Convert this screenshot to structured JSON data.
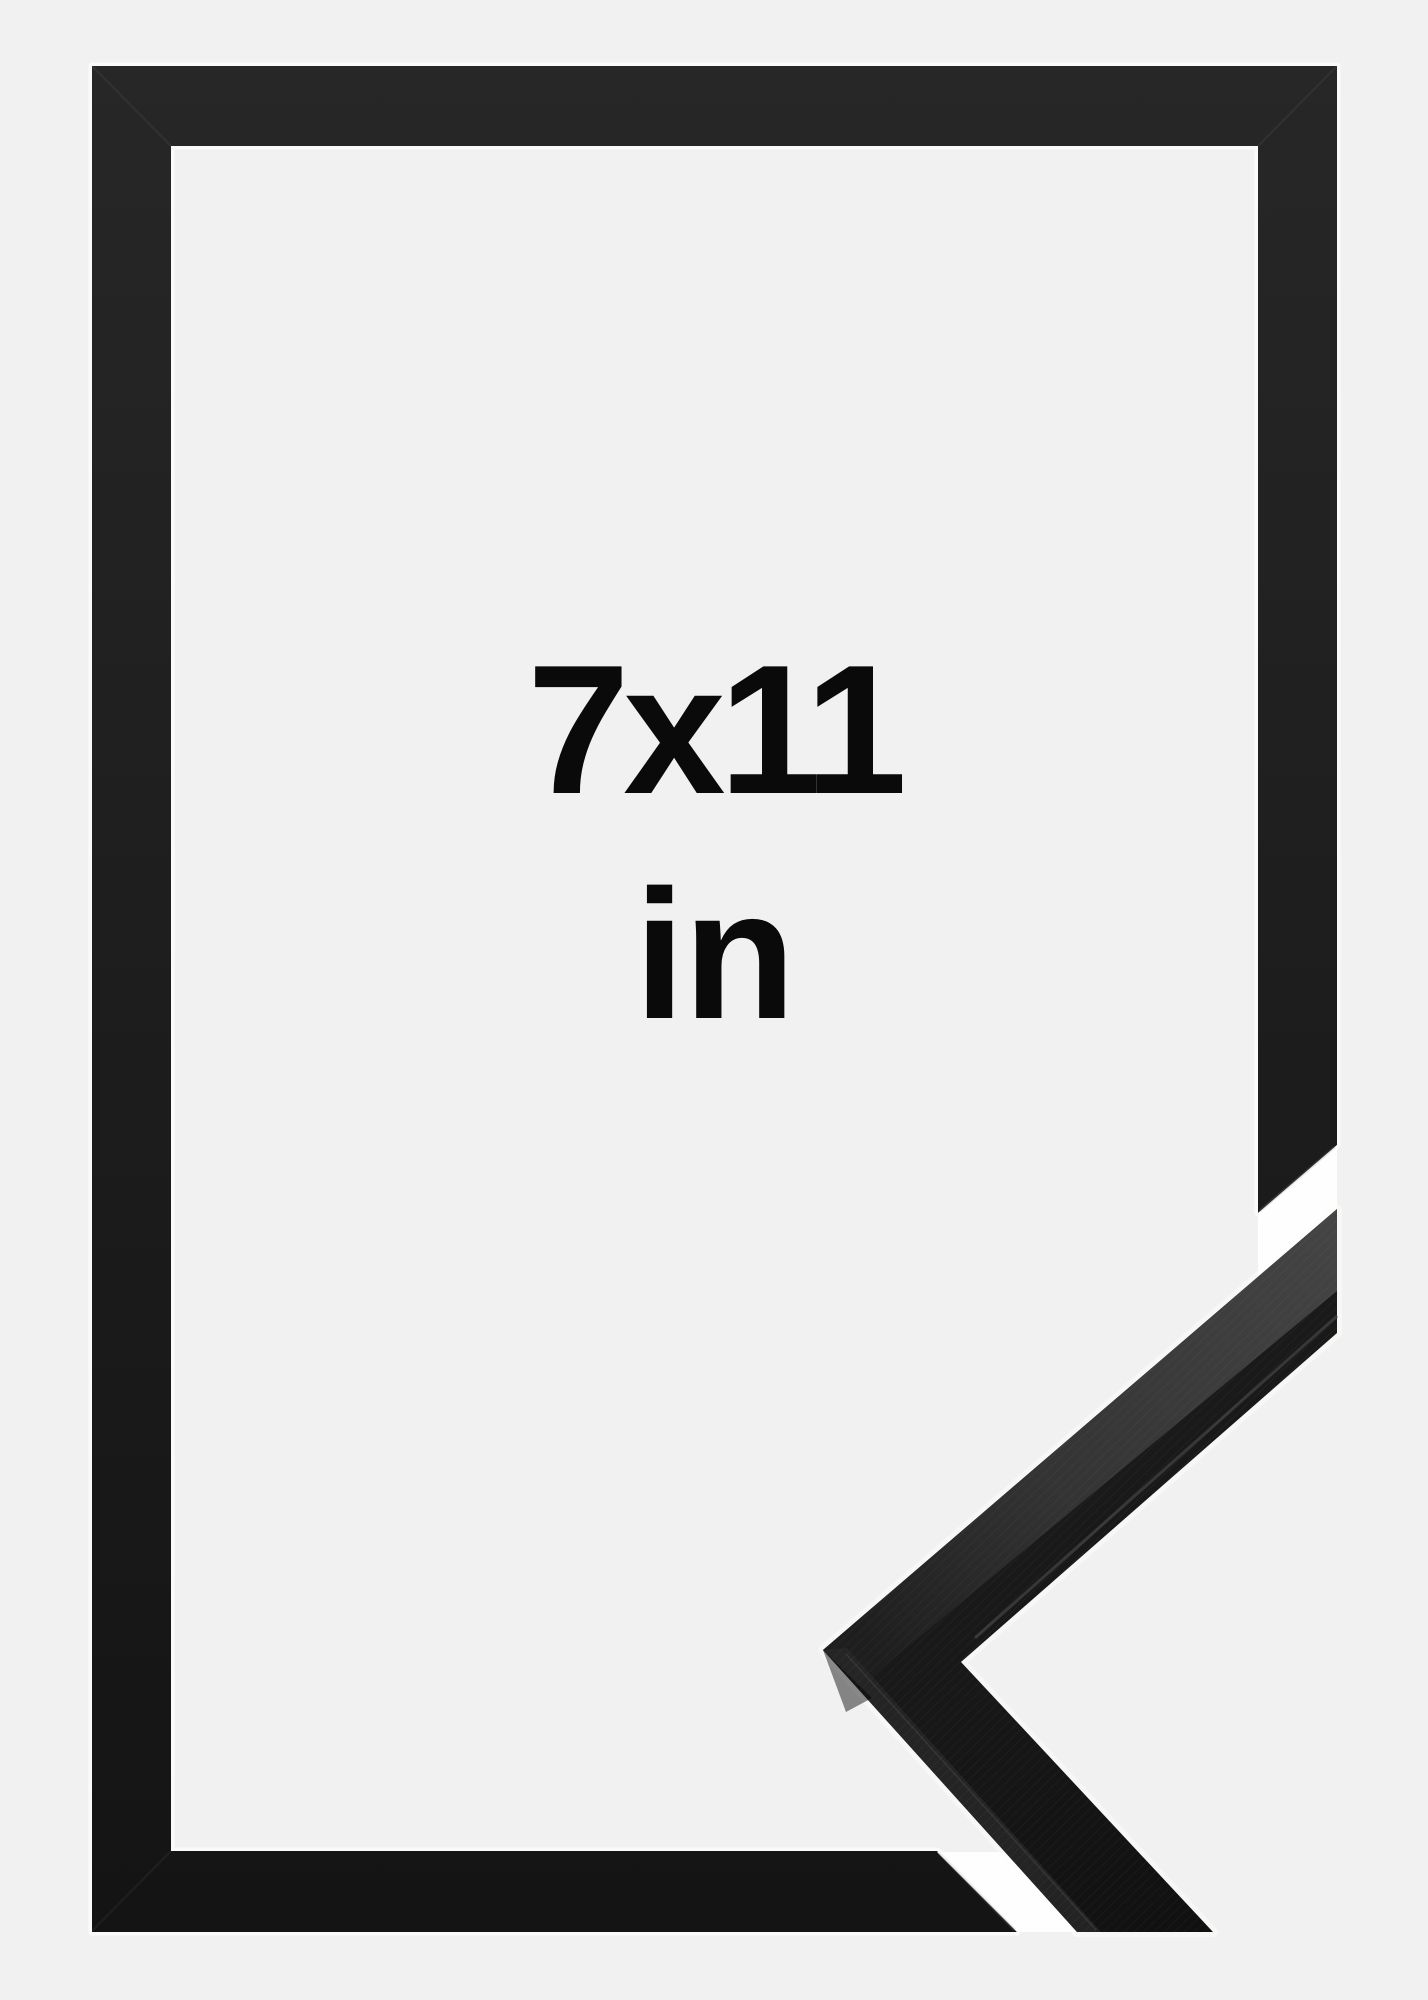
{
  "product": {
    "size_label": "7x11",
    "unit_label": "in"
  },
  "colors": {
    "background": "#f1f1f1",
    "frame": "#1c1c1c",
    "text": "#0a0a0a",
    "halo": "#fbfbf9",
    "profile_top_face": "#3f3f3f"
  }
}
